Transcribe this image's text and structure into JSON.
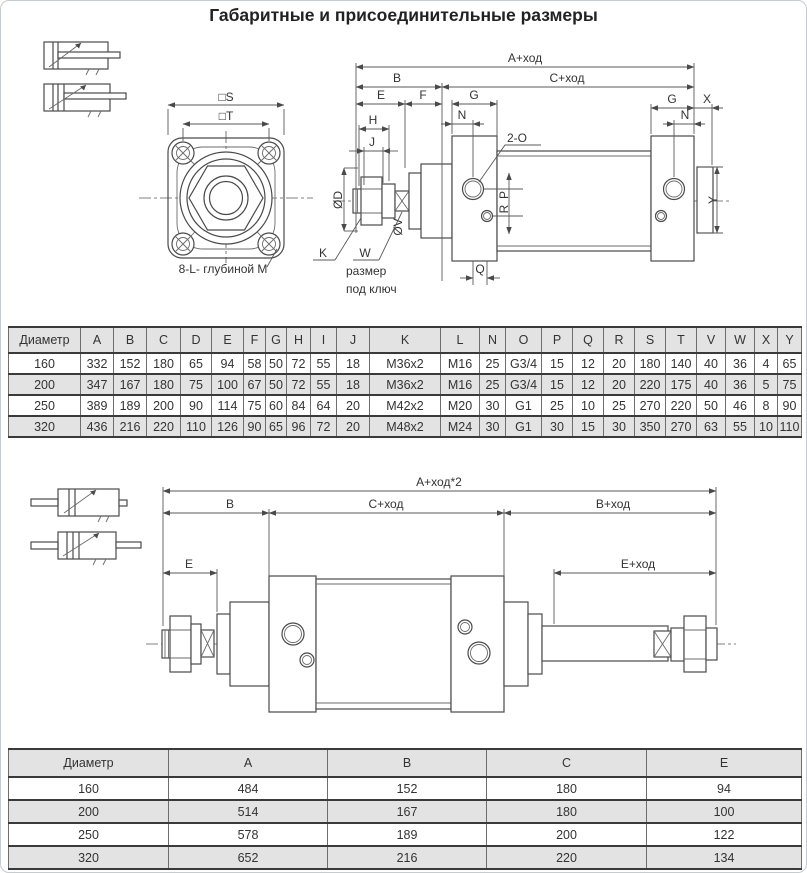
{
  "title": "Габаритные и присоединительные размеры",
  "drawing1": {
    "flange": {
      "s": "□S",
      "t": "□T",
      "note": "8-L- глубиной M"
    },
    "dims": {
      "a": "A+ход",
      "b": "B",
      "c": "C+ход",
      "e": "E",
      "f": "F",
      "g_left": "G",
      "g_right": "G",
      "x": "X",
      "h": "H",
      "j": "J",
      "n_left": "N",
      "n_right": "N",
      "ports": "2-O",
      "p": "P",
      "r": "R",
      "q_left": "Q",
      "q_right": "Q",
      "y": "Y",
      "od": "ØD",
      "ov": "ØV",
      "k": "K",
      "w": "W",
      "w_note1": "размер",
      "w_note2": "под ключ"
    }
  },
  "table1": {
    "headers": [
      "Диаметр",
      "A",
      "B",
      "C",
      "D",
      "E",
      "F",
      "G",
      "H",
      "I",
      "J",
      "K",
      "L",
      "N",
      "O",
      "P",
      "Q",
      "R",
      "S",
      "T",
      "V",
      "W",
      "X",
      "Y"
    ],
    "rows": [
      [
        "160",
        "332",
        "152",
        "180",
        "65",
        "94",
        "58",
        "50",
        "72",
        "55",
        "18",
        "M36x2",
        "M16",
        "25",
        "G3/4",
        "15",
        "12",
        "20",
        "180",
        "140",
        "40",
        "36",
        "4",
        "65"
      ],
      [
        "200",
        "347",
        "167",
        "180",
        "75",
        "100",
        "67",
        "50",
        "72",
        "55",
        "18",
        "M36x2",
        "M16",
        "25",
        "G3/4",
        "15",
        "12",
        "20",
        "220",
        "175",
        "40",
        "36",
        "5",
        "75"
      ],
      [
        "250",
        "389",
        "189",
        "200",
        "90",
        "114",
        "75",
        "60",
        "84",
        "64",
        "20",
        "M42x2",
        "M20",
        "30",
        "G1",
        "25",
        "10",
        "25",
        "270",
        "220",
        "50",
        "46",
        "8",
        "90"
      ],
      [
        "320",
        "436",
        "216",
        "220",
        "110",
        "126",
        "90",
        "65",
        "96",
        "72",
        "20",
        "M48x2",
        "M24",
        "30",
        "G1",
        "30",
        "15",
        "30",
        "350",
        "270",
        "63",
        "55",
        "10",
        "110"
      ]
    ]
  },
  "drawing2": {
    "dims": {
      "a2": "A+ход*2",
      "b": "B",
      "c": "C+ход",
      "b2": "B+ход",
      "e": "E",
      "e2": "E+ход"
    }
  },
  "table2": {
    "headers": [
      "Диаметр",
      "A",
      "B",
      "C",
      "E"
    ],
    "rows": [
      [
        "160",
        "484",
        "152",
        "180",
        "94"
      ],
      [
        "200",
        "514",
        "167",
        "180",
        "100"
      ],
      [
        "250",
        "578",
        "189",
        "200",
        "122"
      ],
      [
        "320",
        "652",
        "216",
        "220",
        "134"
      ]
    ]
  }
}
